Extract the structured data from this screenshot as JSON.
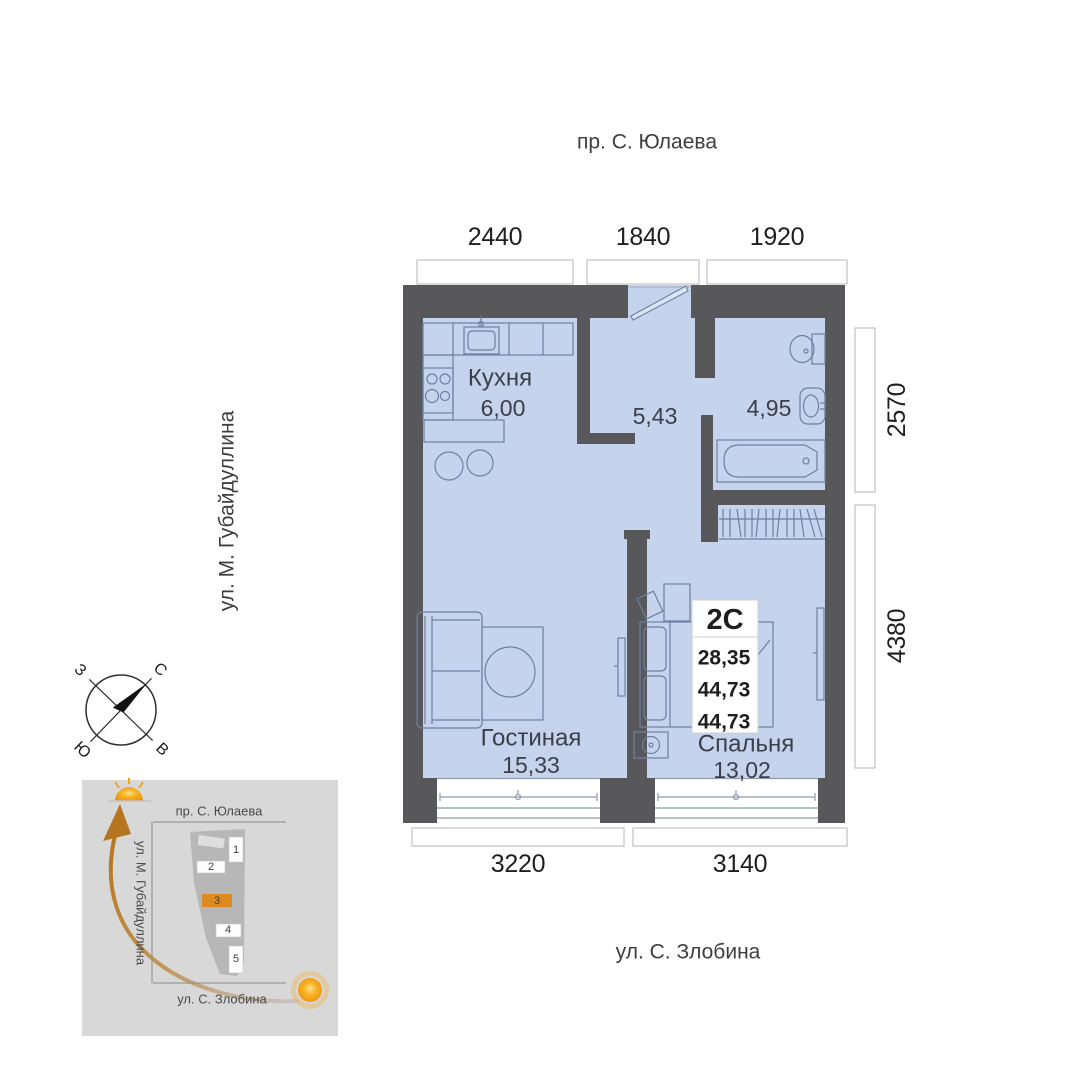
{
  "streets": {
    "top": "пр. С. Юлаева",
    "left": "ул. М. Губайдуллина",
    "bottom": "ул. С. Злобина"
  },
  "dimensions": {
    "top": [
      "2440",
      "1840",
      "1920"
    ],
    "right": [
      "2570",
      "4380"
    ],
    "bottom": [
      "3220",
      "3140"
    ]
  },
  "rooms": {
    "kitchen": {
      "name": "Кухня",
      "area": "6,00"
    },
    "hallway": {
      "area": "5,43"
    },
    "bathroom": {
      "area": "4,95"
    },
    "living": {
      "name": "Гостиная",
      "area": "15,33"
    },
    "bedroom": {
      "name": "Спальня",
      "area": "13,02"
    }
  },
  "info_box": {
    "type": "2С",
    "values": [
      "28,35",
      "44,73",
      "44,73"
    ]
  },
  "compass": {
    "n": "С",
    "e": "В",
    "s": "Ю",
    "w": "З"
  },
  "minimap": {
    "street_top": "пр. С. Юлаева",
    "street_left": "ул. М. Губайдуллина",
    "street_bottom": "ул. С. Злобина",
    "blocks": [
      "1",
      "2",
      "3",
      "4",
      "5"
    ],
    "highlighted_block": "3"
  },
  "colors": {
    "wall": "#58585A",
    "floor": "#C6D3EC",
    "accent_orange": "#DE8A1E",
    "fixture_line": "#6D80A2",
    "minimap_bg": "#D8D8D8",
    "building": "#B7B7B7"
  }
}
